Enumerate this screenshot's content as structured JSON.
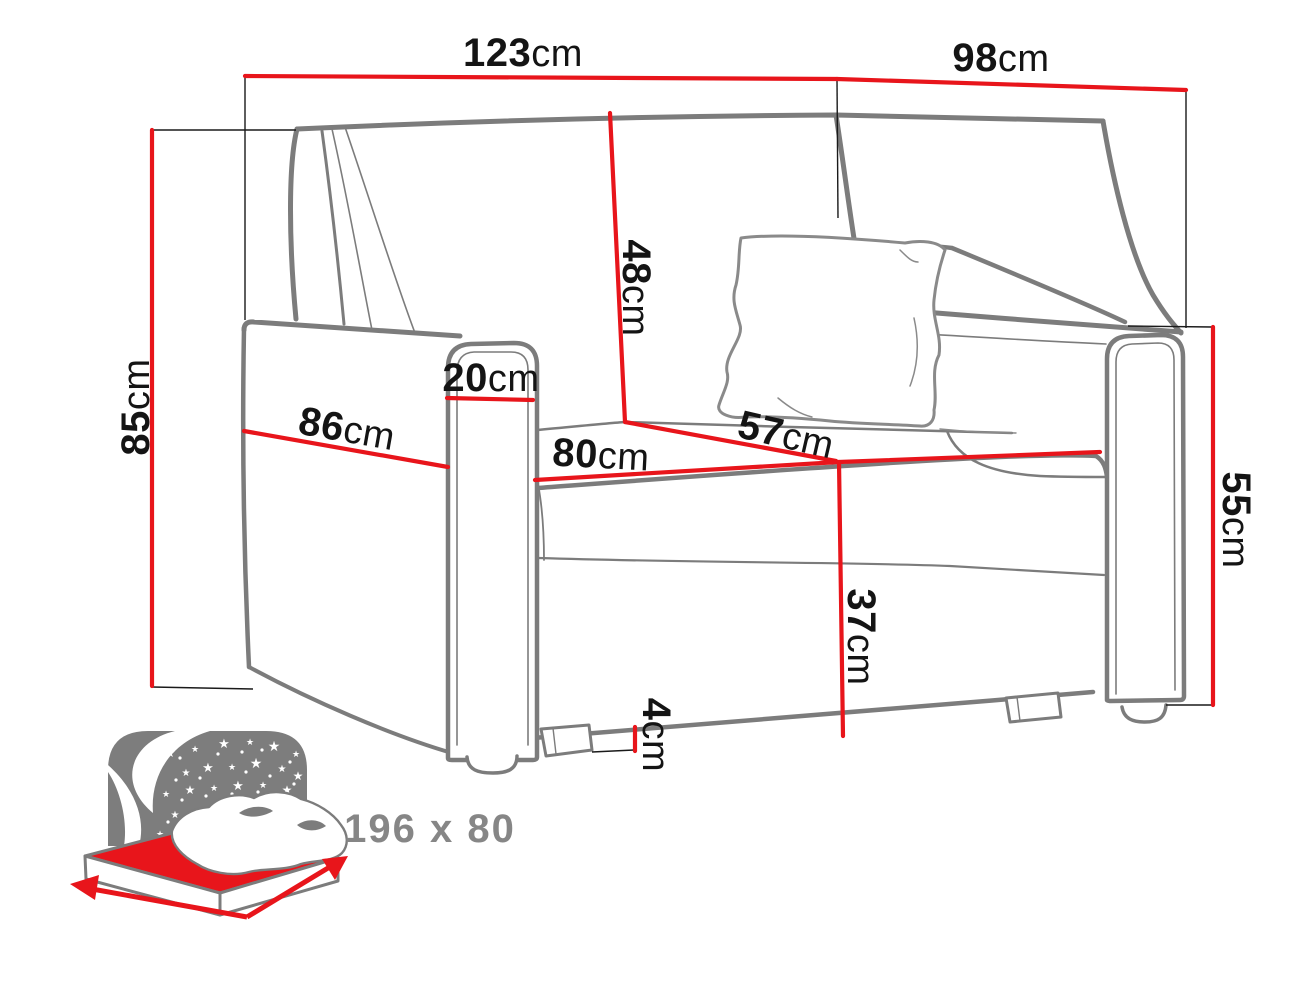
{
  "diagram_type": "sofa-bed dimension diagram",
  "colors": {
    "dimension_line_red": "#e8151b",
    "outline_gray": "#7c7c7c",
    "label_text": "#141414",
    "sleeping_text_gray": "#868686",
    "night_panel_gray": "#7d7d7d",
    "mattress_red": "#e8151b"
  },
  "dims": {
    "overall_width": {
      "value": "123",
      "unit": "cm"
    },
    "overall_depth": {
      "value": "98",
      "unit": "cm"
    },
    "overall_height": {
      "value": "85",
      "unit": "cm"
    },
    "backrest_height": {
      "value": "48",
      "unit": "cm"
    },
    "armrest_width": {
      "value": "20",
      "unit": "cm"
    },
    "side_depth": {
      "value": "86",
      "unit": "cm"
    },
    "seat_width": {
      "value": "80",
      "unit": "cm"
    },
    "seat_depth": {
      "value": "57",
      "unit": "cm"
    },
    "seat_height": {
      "value": "37",
      "unit": "cm"
    },
    "foot_height": {
      "value": "4",
      "unit": "cm"
    },
    "armrest_height": {
      "value": "55",
      "unit": "cm"
    }
  },
  "sleeping_area": {
    "label": "196 x 80",
    "icon": "bed-sleeping-icon"
  }
}
